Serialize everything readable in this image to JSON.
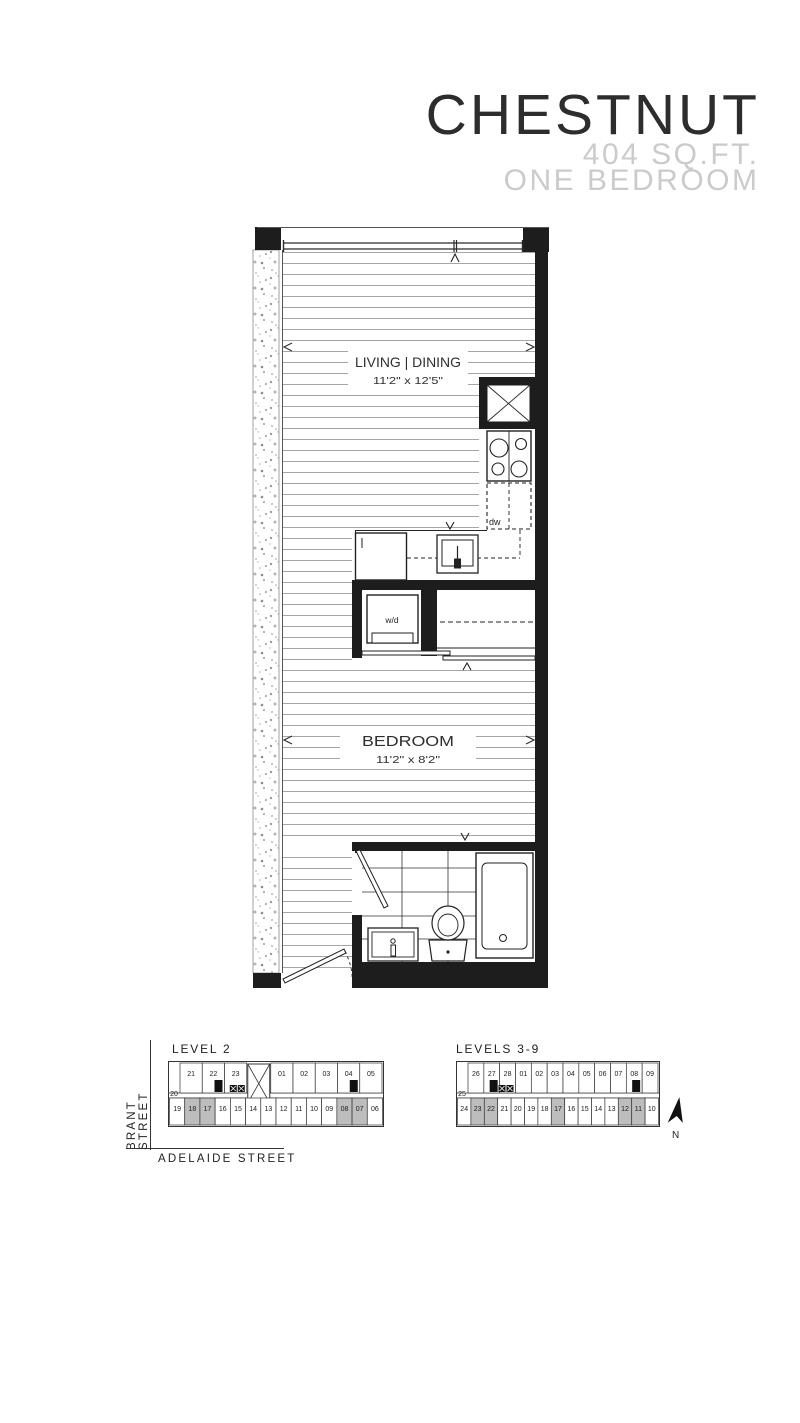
{
  "header": {
    "title": "CHESTNUT",
    "area": "404 SQ.FT.",
    "type": "ONE BEDROOM"
  },
  "floorplan": {
    "living_label": "LIVING | DINING",
    "living_dims": "11'2\" x 12'5\"",
    "bedroom_label": "BEDROOM",
    "bedroom_dims": "11'2\" x 8'2\"",
    "dishwasher_label": "dw",
    "washer_dryer_label": "w/d"
  },
  "keyplans": {
    "streets": {
      "vertical": "BRANT STREET",
      "horizontal": "ADELAIDE STREET"
    },
    "north_label": "N",
    "level2": {
      "label": "LEVEL 2",
      "top_units": [
        "21",
        "22",
        "23",
        "01",
        "02",
        "03",
        "04",
        "05"
      ],
      "shaft_index": 3,
      "elevators_after": 2,
      "mid_unit": "20",
      "bottom_units": [
        "19",
        "18",
        "17",
        "16",
        "15",
        "14",
        "13",
        "12",
        "11",
        "10",
        "09",
        "08",
        "07",
        "06"
      ],
      "shaded_units": [
        "18",
        "17",
        "08",
        "07"
      ],
      "marker_units": [
        "22",
        "04"
      ]
    },
    "levels39": {
      "label": "LEVELS 3-9",
      "top_units": [
        "26",
        "27",
        "28",
        "01",
        "02",
        "03",
        "04",
        "05",
        "06",
        "07",
        "08",
        "09"
      ],
      "shaft_index": -1,
      "elevators_after": 2,
      "mid_unit": "25",
      "bottom_units": [
        "24",
        "23",
        "22",
        "21",
        "20",
        "19",
        "18",
        "17",
        "16",
        "15",
        "14",
        "13",
        "12",
        "11",
        "10"
      ],
      "shaded_units": [
        "23",
        "22",
        "17",
        "12",
        "11"
      ],
      "marker_units": [
        "27",
        "08"
      ]
    }
  },
  "colors": {
    "wall": "#1d1d1d",
    "floor_line": "#9b9b9b",
    "shaded_unit": "#bdbdbd",
    "subtitle": "#cbcbcb"
  }
}
